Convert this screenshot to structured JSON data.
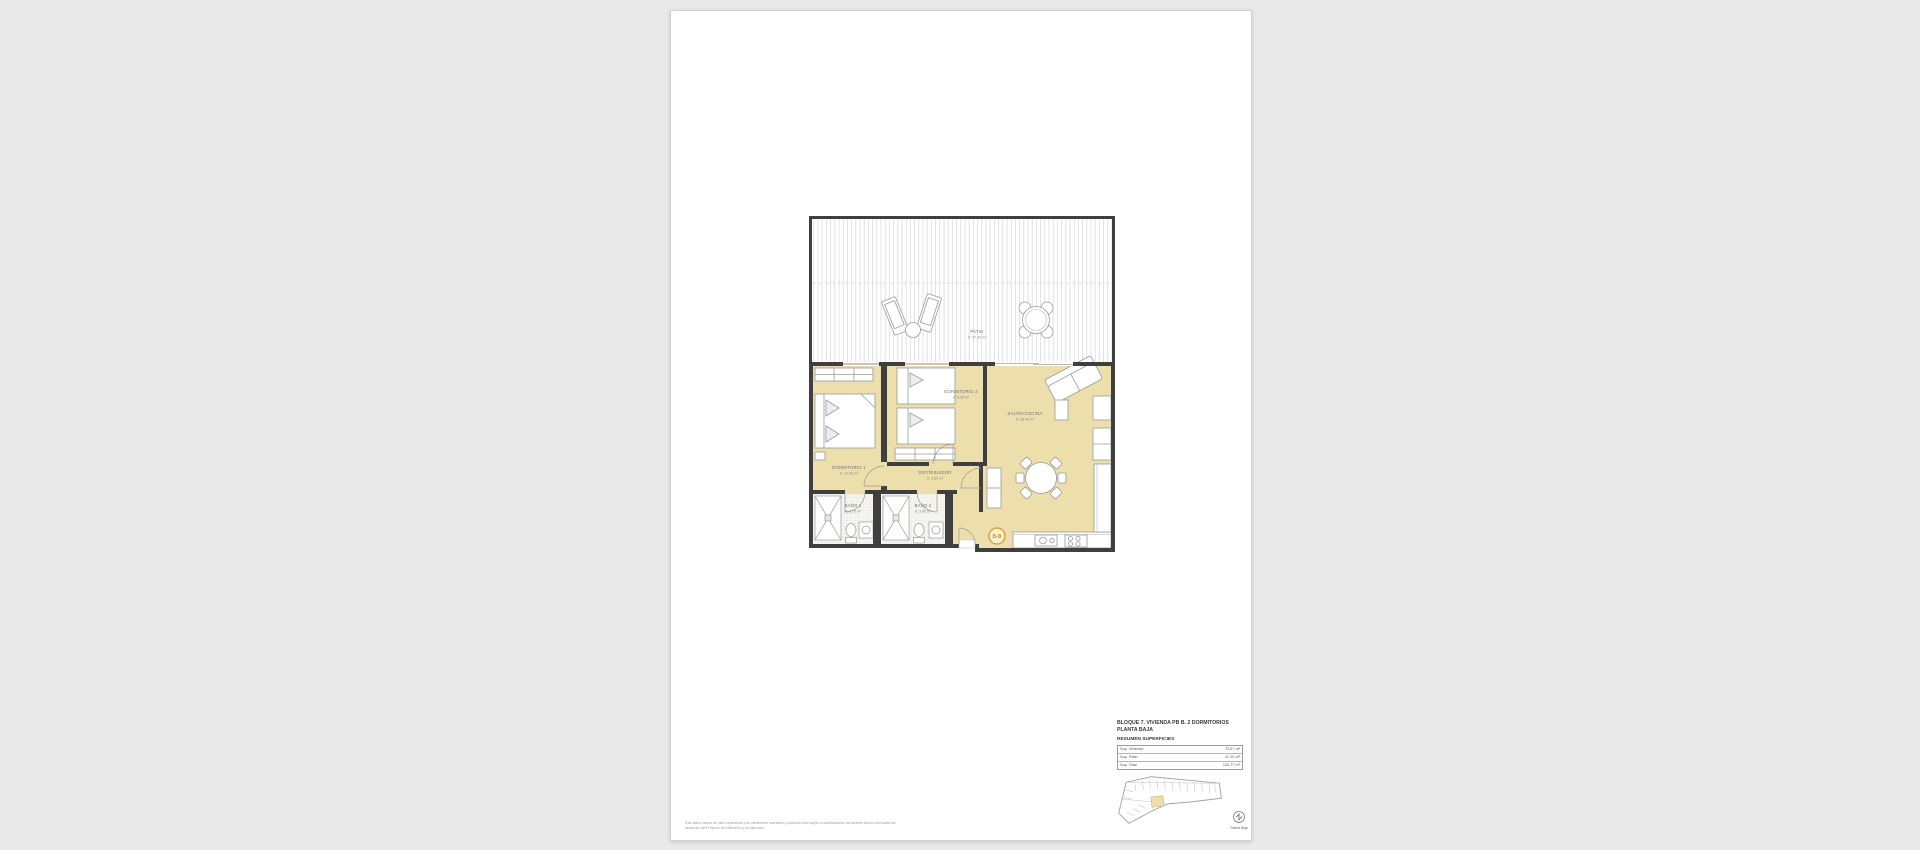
{
  "canvas": {
    "background": "#e9e9e9",
    "sheet_color": "#ffffff"
  },
  "plan": {
    "colors": {
      "floor": "#ecdfac",
      "wall": "#3f3f3f",
      "tile": "#f7f6f1",
      "furniture_stroke": "#9a9a9a",
      "label": "#6f6f6f",
      "marker_orange": "#d59a2e"
    },
    "rooms": {
      "patio": {
        "name": "PATIO",
        "area": "S: 47,20 m²"
      },
      "dorm1": {
        "name": "DORMITORIO 1",
        "area": "S: 11,95 m²"
      },
      "dorm2": {
        "name": "DORMITORIO 2",
        "area": "S: 9,35 m²"
      },
      "salon": {
        "name": "SALÓN-COCINA",
        "area": "S: 28,40 m²"
      },
      "distribuidor": {
        "name": "DISTRIBUIDOR",
        "area": "S: 2,80 m²"
      },
      "bano1": {
        "name": "BAÑO 1",
        "area": "S: 3,75 m²"
      },
      "bano2": {
        "name": "BAÑO 2",
        "area": "S: 3,45 m²"
      }
    },
    "section_marker": "B-B"
  },
  "title_block": {
    "title_line1": "BLOQUE 7. VIVIENDA PB B. 2 DORMITORIOS",
    "title_line2": "PLANTA BAJA",
    "subtitle": "RESUMEN SUPERFICIES",
    "table": [
      {
        "label": "Sup. Vivienda",
        "value": "73,57 m²"
      },
      {
        "label": "Sup. Patio",
        "value": "47,20 m²"
      },
      {
        "label": "Sup. Total",
        "value": "120,77 m²"
      }
    ],
    "keyplan_caption": "Planta Baja"
  },
  "footer": {
    "disclaimer_line1": "Este plano carece de valor contractual y es meramente orientativo, pudiendo estar sujeto a modificaciones de carácter técnico derivadas del",
    "disclaimer_line2": "desarrollo del Proyecto de Edificación y su ejecución."
  }
}
